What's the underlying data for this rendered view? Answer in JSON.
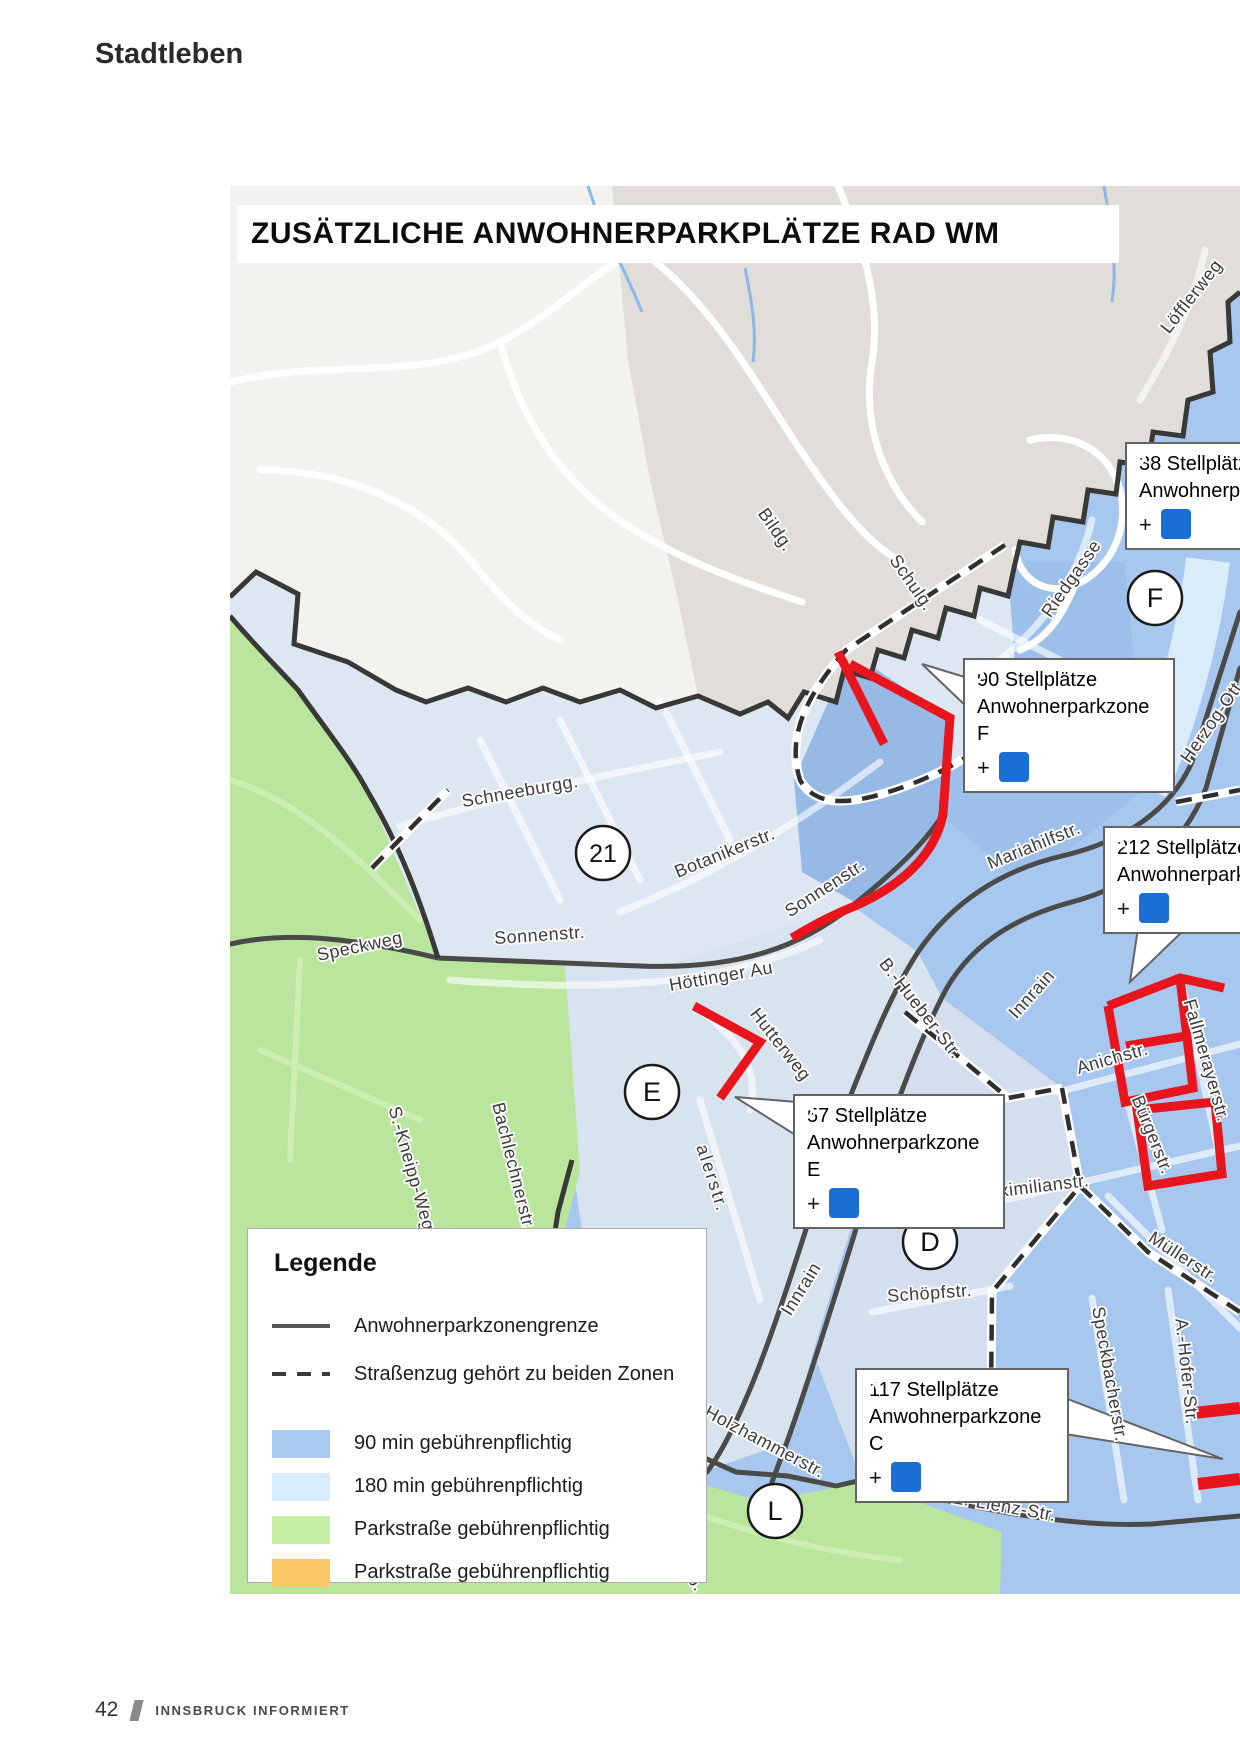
{
  "page": {
    "section_title": "Stadtleben",
    "footer": {
      "page_number": "42",
      "publication_name": "INNSBRUCK INFORMIERT"
    }
  },
  "map": {
    "title": "ZUSÄTZLICHE ANWOHNERPARKPLÄTZE RAD WM",
    "callout_plus": "+",
    "colors": {
      "zone_90min": "#a7c7ef",
      "zone_90min_dark": "#96b9e6",
      "zone_90min_mid": "#9dc0ea",
      "zone_180min": "#dde7f2",
      "zone_180min_b": "#d8e3f0",
      "zone_180min_c": "#d3dfee",
      "pale_strip": "#d8ecfa",
      "parkstrasse_green": "#b9e69c",
      "parkstrasse_orange": "#fbc868",
      "terrain_white": "#f4f2ef",
      "built_gray": "#e1ded9",
      "highlight_red": "#e8151c",
      "wheelchair_blue": "#1a6fd4"
    },
    "legend": {
      "heading": "Legende",
      "items": [
        {
          "swatch": "line-solid",
          "color": "#555555",
          "label": "Anwohnerparkzonengrenze"
        },
        {
          "swatch": "line-dashed",
          "color": "#3a3a3a",
          "label": "Straßenzug gehört zu beiden Zonen"
        },
        {
          "swatch": "fill",
          "color": "#a8c9f1",
          "label": "90 min gebührenpflichtig"
        },
        {
          "swatch": "fill",
          "color": "#d7ecfc",
          "label": "180 min gebührenpflichtig"
        },
        {
          "swatch": "fill",
          "color": "#c6efa5",
          "label": "Parkstraße gebührenpflichtig"
        },
        {
          "swatch": "fill",
          "color": "#fcc867",
          "label": "Parkstraße gebührenpflichtig"
        }
      ]
    },
    "zone_markers": [
      {
        "label": "F",
        "x": 1155,
        "y": 598
      },
      {
        "label": "21",
        "x": 603,
        "y": 853
      },
      {
        "label": "E",
        "x": 652,
        "y": 1092
      },
      {
        "label": "D",
        "x": 930,
        "y": 1242
      },
      {
        "label": "L",
        "x": 775,
        "y": 1511
      }
    ],
    "callouts": [
      {
        "id": "zone-38",
        "lines": [
          "38 Stellplätze",
          "Anwohnerparkzone"
        ],
        "wheelchair": true,
        "x": 1125,
        "y": 442,
        "w": 230
      },
      {
        "id": "zone-f",
        "lines": [
          "90 Stellplätze",
          "Anwohnerparkzone F"
        ],
        "wheelchair": true,
        "x": 963,
        "y": 658,
        "w": 212
      },
      {
        "id": "zone-212",
        "lines": [
          "212 Stellplätze",
          "Anwohnerparkzone"
        ],
        "wheelchair": true,
        "x": 1103,
        "y": 826,
        "w": 230
      },
      {
        "id": "zone-e",
        "lines": [
          "57 Stellplätze",
          "Anwohnerparkzone E"
        ],
        "wheelchair": true,
        "x": 793,
        "y": 1094,
        "w": 212
      },
      {
        "id": "zone-c",
        "lines": [
          "117 Stellplätze",
          "Anwohnerparkzone C"
        ],
        "wheelchair": true,
        "x": 855,
        "y": 1368,
        "w": 214
      }
    ],
    "streets": [
      {
        "name": "Löfflerweg",
        "x": 1196,
        "y": 300,
        "rot": -52
      },
      {
        "name": "Bildg.",
        "x": 771,
        "y": 533,
        "rot": 55
      },
      {
        "name": "Schulg.",
        "x": 907,
        "y": 586,
        "rot": 55
      },
      {
        "name": "Riedgasse",
        "x": 1076,
        "y": 582,
        "rot": -55
      },
      {
        "name": "Herzog-Ott",
        "x": 1216,
        "y": 726,
        "rot": -55
      },
      {
        "name": "Schneeburgg.",
        "x": 521,
        "y": 797,
        "rot": -10
      },
      {
        "name": "Botanikerstr.",
        "x": 727,
        "y": 858,
        "rot": -22
      },
      {
        "name": "Sonnenstr.",
        "x": 828,
        "y": 893,
        "rot": -33
      },
      {
        "name": "Mariahilfstr.",
        "x": 1036,
        "y": 851,
        "rot": -22
      },
      {
        "name": "Speckweg",
        "x": 361,
        "y": 952,
        "rot": -12
      },
      {
        "name": "Sonnenstr.",
        "x": 540,
        "y": 941,
        "rot": -4
      },
      {
        "name": "Höttinger Au",
        "x": 722,
        "y": 982,
        "rot": -10
      },
      {
        "name": "B.-Hueber-Str.",
        "x": 916,
        "y": 1012,
        "rot": 52
      },
      {
        "name": "Innrain",
        "x": 1036,
        "y": 998,
        "rot": -48
      },
      {
        "name": "Hutterweg",
        "x": 776,
        "y": 1048,
        "rot": 52
      },
      {
        "name": "Anichstr.",
        "x": 1114,
        "y": 1064,
        "rot": -16
      },
      {
        "name": "Fallmerayerstr.",
        "x": 1201,
        "y": 1062,
        "rot": 74
      },
      {
        "name": "Bürgerstr.",
        "x": 1147,
        "y": 1137,
        "rot": 68
      },
      {
        "name": "S.-Kneipp-Weg",
        "x": 406,
        "y": 1170,
        "rot": 74
      },
      {
        "name": "Bachlechnerstr.",
        "x": 508,
        "y": 1168,
        "rot": 76
      },
      {
        "name": "alerstr.",
        "x": 707,
        "y": 1180,
        "rot": 72,
        "ls": 2
      },
      {
        "name": "Maximilianstr.",
        "x": 1032,
        "y": 1193,
        "rot": -7
      },
      {
        "name": "Müllerstr.",
        "x": 1180,
        "y": 1262,
        "rot": 33
      },
      {
        "name": "Innrain",
        "x": 806,
        "y": 1292,
        "rot": -58
      },
      {
        "name": "Schöpfstr.",
        "x": 930,
        "y": 1299,
        "rot": -4
      },
      {
        "name": "Speckbacherstr.",
        "x": 1104,
        "y": 1375,
        "rot": 80
      },
      {
        "name": "A.-Hofer-Str.",
        "x": 1181,
        "y": 1372,
        "rot": 84
      },
      {
        "name": "Holzhammerstr.",
        "x": 762,
        "y": 1447,
        "rot": 28
      },
      {
        "name": "E.-Lienz-Str.",
        "x": 1003,
        "y": 1512,
        "rot": 10
      },
      {
        "name": "lb.",
        "x": 690,
        "y": 1584,
        "rot": 55
      }
    ]
  }
}
